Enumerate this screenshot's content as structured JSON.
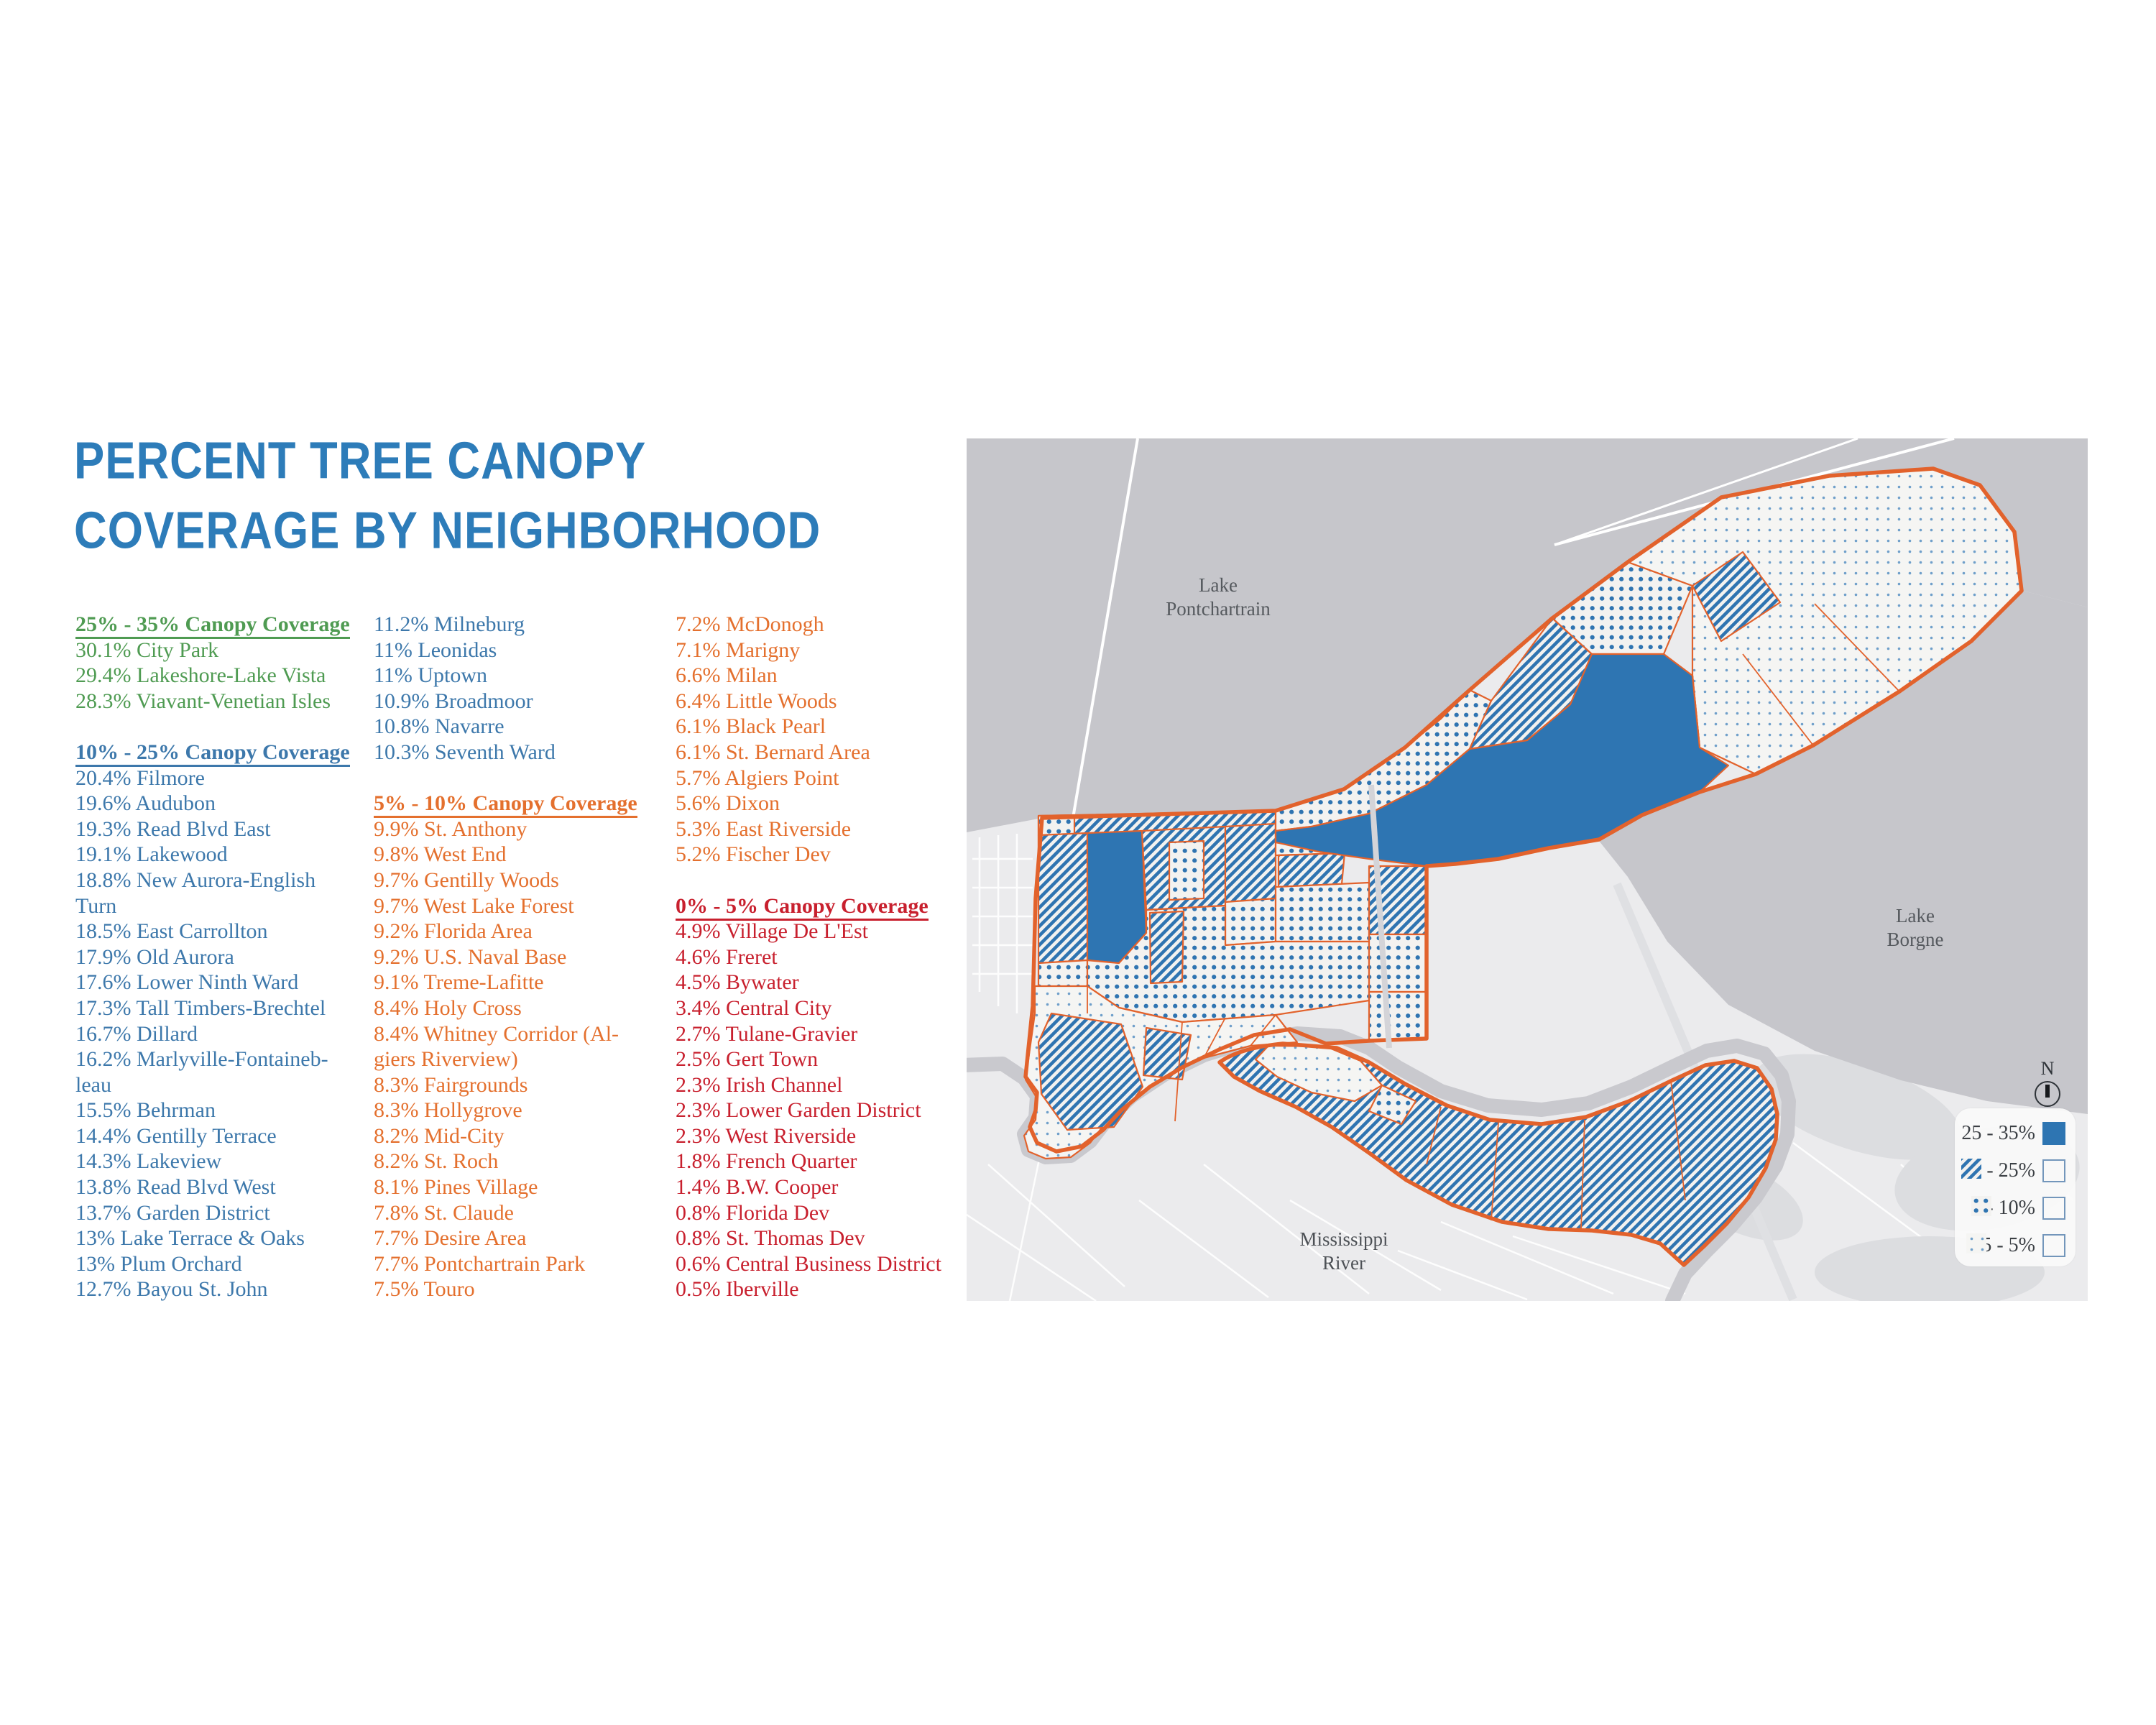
{
  "title": {
    "line1": "PERCENT TREE CANOPY",
    "line2": "COVERAGE BY NEIGHBORHOOD"
  },
  "colors": {
    "title_blue": "#2d7cb9",
    "group_25_35_green": "#4f9b52",
    "group_10_25_blue": "#3d78ab",
    "group_5_10_orange": "#e4702e",
    "group_0_5_red": "#c8202e",
    "map_boundary_orange": "#e2622c",
    "canopy_solid_blue": "#2e75b2",
    "water_gray": "#c6c6cb",
    "land_gray": "#ebebed"
  },
  "columns": [
    {
      "lines": [
        {
          "t": "25% - 35% Canopy Coverage",
          "c": "g",
          "h": true
        },
        {
          "t": "30.1% City Park",
          "c": "g"
        },
        {
          "t": "29.4% Lakeshore-Lake Vista",
          "c": "g"
        },
        {
          "t": "28.3% Viavant-Venetian Isles",
          "c": "g"
        },
        {
          "t": ""
        },
        {
          "t": "10% - 25% Canopy Coverage",
          "c": "b",
          "h": true
        },
        {
          "t": "20.4% Filmore",
          "c": "b"
        },
        {
          "t": "19.6% Audubon",
          "c": "b"
        },
        {
          "t": "19.3% Read Blvd East",
          "c": "b"
        },
        {
          "t": "19.1% Lakewood",
          "c": "b"
        },
        {
          "t": "18.8% New Aurora-English",
          "c": "b"
        },
        {
          "t": "Turn",
          "c": "b"
        },
        {
          "t": "18.5% East Carrollton",
          "c": "b"
        },
        {
          "t": "17.9% Old Aurora",
          "c": "b"
        },
        {
          "t": "17.6% Lower Ninth Ward",
          "c": "b"
        },
        {
          "t": "17.3% Tall Timbers-Brechtel",
          "c": "b"
        },
        {
          "t": "16.7% Dillard",
          "c": "b"
        },
        {
          "t": "16.2% Marlyville-Fontaineb-",
          "c": "b"
        },
        {
          "t": "leau",
          "c": "b"
        },
        {
          "t": "15.5% Behrman",
          "c": "b"
        },
        {
          "t": "14.4% Gentilly Terrace",
          "c": "b"
        },
        {
          "t": "14.3% Lakeview",
          "c": "b"
        },
        {
          "t": "13.8% Read Blvd West",
          "c": "b"
        },
        {
          "t": "13.7% Garden District",
          "c": "b"
        },
        {
          "t": "13% Lake Terrace & Oaks",
          "c": "b"
        },
        {
          "t": "13% Plum Orchard",
          "c": "b"
        },
        {
          "t": "12.7% Bayou St. John",
          "c": "b"
        }
      ]
    },
    {
      "lines": [
        {
          "t": "11.2% Milneburg",
          "c": "b"
        },
        {
          "t": "11% Leonidas",
          "c": "b"
        },
        {
          "t": "11% Uptown",
          "c": "b"
        },
        {
          "t": "10.9% Broadmoor",
          "c": "b"
        },
        {
          "t": "10.8% Navarre",
          "c": "b"
        },
        {
          "t": "10.3% Seventh Ward",
          "c": "b"
        },
        {
          "t": ""
        },
        {
          "t": "5% - 10% Canopy Coverage",
          "c": "o",
          "h": true
        },
        {
          "t": "9.9% St. Anthony",
          "c": "o"
        },
        {
          "t": "9.8% West End",
          "c": "o"
        },
        {
          "t": "9.7% Gentilly Woods",
          "c": "o"
        },
        {
          "t": "9.7% West Lake Forest",
          "c": "o"
        },
        {
          "t": "9.2% Florida Area",
          "c": "o"
        },
        {
          "t": "9.2% U.S. Naval Base",
          "c": "o"
        },
        {
          "t": "9.1% Treme-Lafitte",
          "c": "o"
        },
        {
          "t": "8.4% Holy Cross",
          "c": "o"
        },
        {
          "t": "8.4% Whitney Corridor (Al-",
          "c": "o"
        },
        {
          "t": "giers Riverview)",
          "c": "o"
        },
        {
          "t": "8.3% Fairgrounds",
          "c": "o"
        },
        {
          "t": "8.3% Hollygrove",
          "c": "o"
        },
        {
          "t": "8.2% Mid-City",
          "c": "o"
        },
        {
          "t": "8.2% St. Roch",
          "c": "o"
        },
        {
          "t": "8.1% Pines Village",
          "c": "o"
        },
        {
          "t": "7.8% St. Claude",
          "c": "o"
        },
        {
          "t": "7.7% Desire Area",
          "c": "o"
        },
        {
          "t": "7.7% Pontchartrain Park",
          "c": "o"
        },
        {
          "t": "7.5% Touro",
          "c": "o"
        }
      ]
    },
    {
      "lines": [
        {
          "t": "7.2% McDonogh",
          "c": "o"
        },
        {
          "t": "7.1% Marigny",
          "c": "o"
        },
        {
          "t": "6.6% Milan",
          "c": "o"
        },
        {
          "t": "6.4% Little Woods",
          "c": "o"
        },
        {
          "t": "6.1% Black Pearl",
          "c": "o"
        },
        {
          "t": "6.1% St. Bernard Area",
          "c": "o"
        },
        {
          "t": "5.7% Algiers Point",
          "c": "o"
        },
        {
          "t": "5.6% Dixon",
          "c": "o"
        },
        {
          "t": "5.3% East Riverside",
          "c": "o"
        },
        {
          "t": "5.2% Fischer Dev",
          "c": "o"
        },
        {
          "t": ""
        },
        {
          "t": "0% - 5% Canopy Coverage",
          "c": "r",
          "h": true
        },
        {
          "t": "4.9% Village De L'Est",
          "c": "r"
        },
        {
          "t": "4.6% Freret",
          "c": "r"
        },
        {
          "t": "4.5% Bywater",
          "c": "r"
        },
        {
          "t": "3.4% Central City",
          "c": "r"
        },
        {
          "t": "2.7% Tulane-Gravier",
          "c": "r"
        },
        {
          "t": "2.5% Gert Town",
          "c": "r"
        },
        {
          "t": "2.3% Irish Channel",
          "c": "r"
        },
        {
          "t": "2.3% Lower Garden District",
          "c": "r"
        },
        {
          "t": "2.3% West Riverside",
          "c": "r"
        },
        {
          "t": "1.8% French Quarter",
          "c": "r"
        },
        {
          "t": "1.4% B.W. Cooper",
          "c": "r"
        },
        {
          "t": "0.8% Florida Dev",
          "c": "r"
        },
        {
          "t": "0.8% St. Thomas Dev",
          "c": "r"
        },
        {
          "t": "0.6% Central Business District",
          "c": "r"
        },
        {
          "t": "0.5% Iberville",
          "c": "r"
        }
      ]
    }
  ],
  "map": {
    "labels": {
      "lake_top": [
        "Lake",
        "Pontchartrain"
      ],
      "lake_right": [
        "Lake",
        "Borgne"
      ],
      "river": [
        "Mississippi",
        "River"
      ]
    },
    "compass": "N",
    "legend": [
      {
        "label": "25 - 35%",
        "pattern": "solid"
      },
      {
        "label": "10 - 25%",
        "pattern": "diagonal-stripes"
      },
      {
        "label": "5 - 10%",
        "pattern": "dense-dots"
      },
      {
        "label": "0.5 - 5%",
        "pattern": "sparse-dots"
      }
    ]
  }
}
